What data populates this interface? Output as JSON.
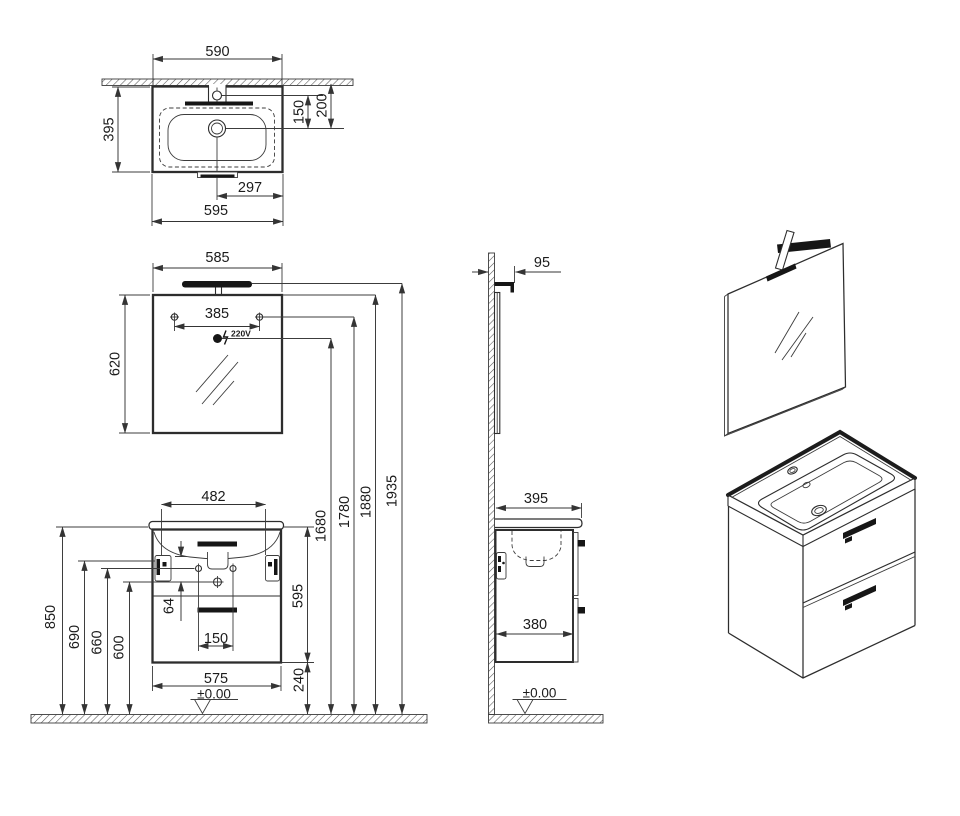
{
  "basin_top": {
    "width_top": "590",
    "depth": "395",
    "faucet_to_drain": "150",
    "wall_to_drain": "200",
    "drain_offset": "297",
    "total_width": "595"
  },
  "mirror_front": {
    "width": "585",
    "screw_spacing": "385",
    "height": "620",
    "power": "220V"
  },
  "mirror_side": {
    "lamp_depth": "95"
  },
  "heights": {
    "socket": "1680",
    "screws": "1780",
    "mirror_top": "1880",
    "lamp_top": "1935"
  },
  "cabinet_front": {
    "bracket_spacing": "482",
    "worktop_height": "850",
    "bracket_height": "690",
    "hole_height": "660",
    "center_hole_height": "600",
    "hole_gap": "64",
    "hole_spacing": "150",
    "width": "575",
    "height": "595",
    "clearance": "240",
    "datum": "±0.00"
  },
  "cabinet_side": {
    "total_depth": "395",
    "body_depth": "380",
    "datum": "±0.00"
  }
}
